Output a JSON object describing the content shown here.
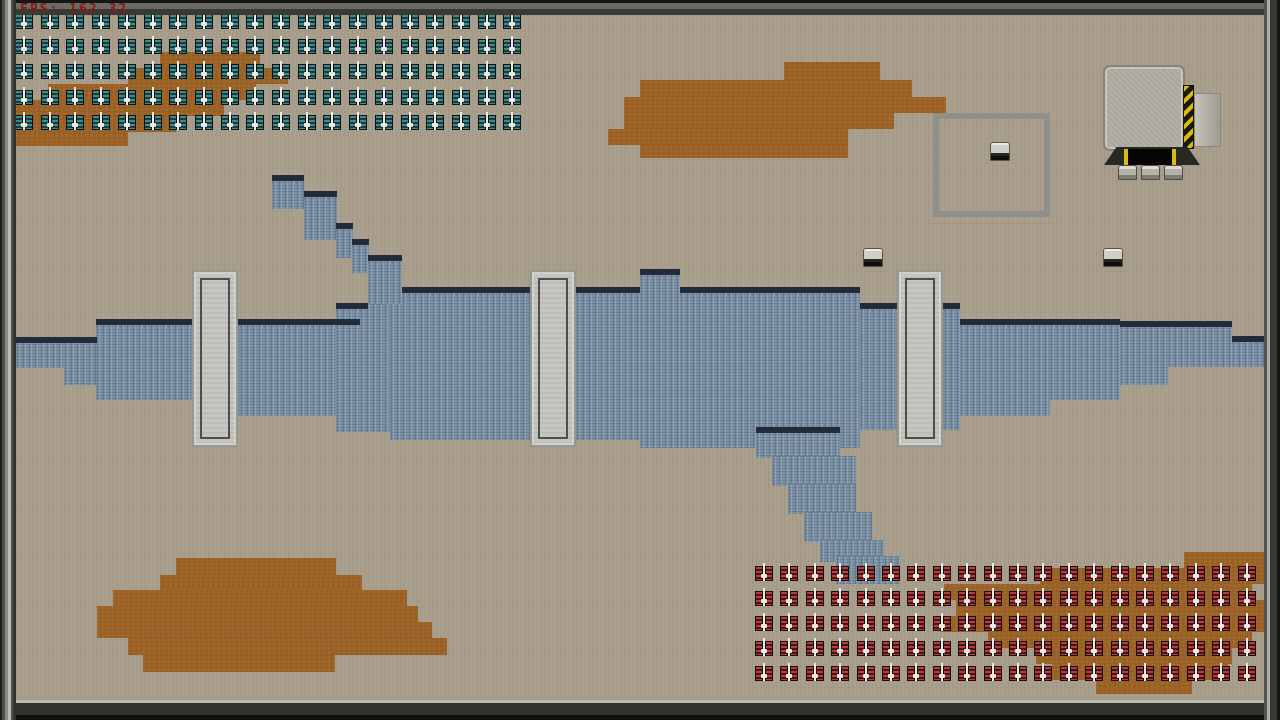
{
  "hud": {
    "fps_label": "FPS: 162.32"
  },
  "colors": {
    "ground": "#a89e8b",
    "dirt": "#9a6227",
    "water": "#7e92a6",
    "water_edge": "#222b39",
    "bridge": "#c5c5c1",
    "teal_unit": "#3f8b8b",
    "red_unit": "#b04040",
    "hazard_yellow": "#d9ba12",
    "fps_text": "#8b1616"
  },
  "terrain": {
    "dirt_rects": [
      [
        160,
        52,
        100,
        16
      ],
      [
        128,
        68,
        160,
        16
      ],
      [
        48,
        84,
        208,
        16
      ],
      [
        16,
        100,
        208,
        16
      ],
      [
        16,
        116,
        160,
        16
      ],
      [
        16,
        132,
        112,
        14
      ],
      [
        784,
        62,
        96,
        18
      ],
      [
        640,
        80,
        272,
        17
      ],
      [
        624,
        97,
        322,
        16
      ],
      [
        624,
        113,
        270,
        16
      ],
      [
        608,
        129,
        240,
        16
      ],
      [
        640,
        145,
        208,
        13
      ],
      [
        176,
        558,
        160,
        17
      ],
      [
        160,
        575,
        202,
        16
      ],
      [
        113,
        590,
        294,
        16
      ],
      [
        97,
        606,
        321,
        16
      ],
      [
        97,
        622,
        335,
        16
      ],
      [
        128,
        638,
        319,
        17
      ],
      [
        143,
        655,
        192,
        17
      ],
      [
        1184,
        552,
        80,
        16
      ],
      [
        1040,
        568,
        224,
        16
      ],
      [
        944,
        584,
        308,
        16
      ],
      [
        956,
        600,
        308,
        16
      ],
      [
        940,
        616,
        324,
        16
      ],
      [
        988,
        632,
        264,
        16
      ],
      [
        1036,
        648,
        196,
        16
      ],
      [
        1052,
        664,
        176,
        16
      ],
      [
        1096,
        680,
        96,
        14
      ]
    ],
    "water_rects": [
      [
        16,
        338,
        48,
        30
      ],
      [
        64,
        338,
        33,
        47
      ],
      [
        96,
        320,
        96,
        80
      ],
      [
        192,
        320,
        168,
        96
      ],
      [
        336,
        304,
        54,
        128
      ],
      [
        390,
        288,
        250,
        152
      ],
      [
        640,
        270,
        40,
        178
      ],
      [
        680,
        288,
        180,
        160
      ],
      [
        860,
        304,
        100,
        126
      ],
      [
        960,
        320,
        90,
        96
      ],
      [
        1050,
        320,
        70,
        80
      ],
      [
        1120,
        322,
        48,
        63
      ],
      [
        1168,
        322,
        64,
        45
      ],
      [
        1232,
        337,
        32,
        30
      ],
      [
        272,
        176,
        32,
        33
      ],
      [
        304,
        192,
        33,
        48
      ],
      [
        336,
        224,
        17,
        34
      ],
      [
        352,
        240,
        17,
        33
      ],
      [
        368,
        256,
        34,
        48
      ],
      [
        756,
        428,
        84,
        30
      ],
      [
        772,
        456,
        84,
        30
      ],
      [
        788,
        484,
        68,
        30
      ],
      [
        804,
        512,
        68,
        30
      ],
      [
        820,
        540,
        64,
        22
      ],
      [
        836,
        556,
        64,
        28
      ]
    ],
    "water_edges": [
      [
        16,
        337,
        81
      ],
      [
        96,
        319,
        264
      ],
      [
        336,
        303,
        32
      ],
      [
        402,
        287,
        238
      ],
      [
        640,
        269,
        40
      ],
      [
        680,
        287,
        180
      ],
      [
        860,
        303,
        100
      ],
      [
        960,
        319,
        160
      ],
      [
        1120,
        321,
        112
      ],
      [
        1232,
        336,
        32
      ],
      [
        272,
        175,
        32
      ],
      [
        304,
        191,
        33
      ],
      [
        336,
        223,
        17
      ],
      [
        352,
        239,
        17
      ],
      [
        368,
        255,
        34
      ],
      [
        756,
        427,
        84
      ]
    ],
    "bridges": [
      [
        192,
        270,
        46,
        177
      ],
      [
        530,
        270,
        46,
        177
      ],
      [
        897,
        270,
        46,
        177
      ]
    ],
    "pods": [
      [
        863,
        248
      ],
      [
        990,
        142
      ],
      [
        1103,
        248
      ]
    ],
    "zone": {
      "x": 933,
      "y": 113,
      "w": 117,
      "h": 104
    },
    "factory": {
      "x": 1100,
      "y": 62
    }
  },
  "units": {
    "groups": [
      {
        "id": "teal-squad",
        "team": "teal",
        "x": 15,
        "y": 14,
        "cols": 20,
        "rows": 5,
        "dx": 25.7,
        "dy": 25.2
      },
      {
        "id": "red-squad",
        "team": "red",
        "x": 755,
        "y": 566,
        "cols": 20,
        "rows": 5,
        "dx": 25.4,
        "dy": 25.0
      }
    ]
  }
}
